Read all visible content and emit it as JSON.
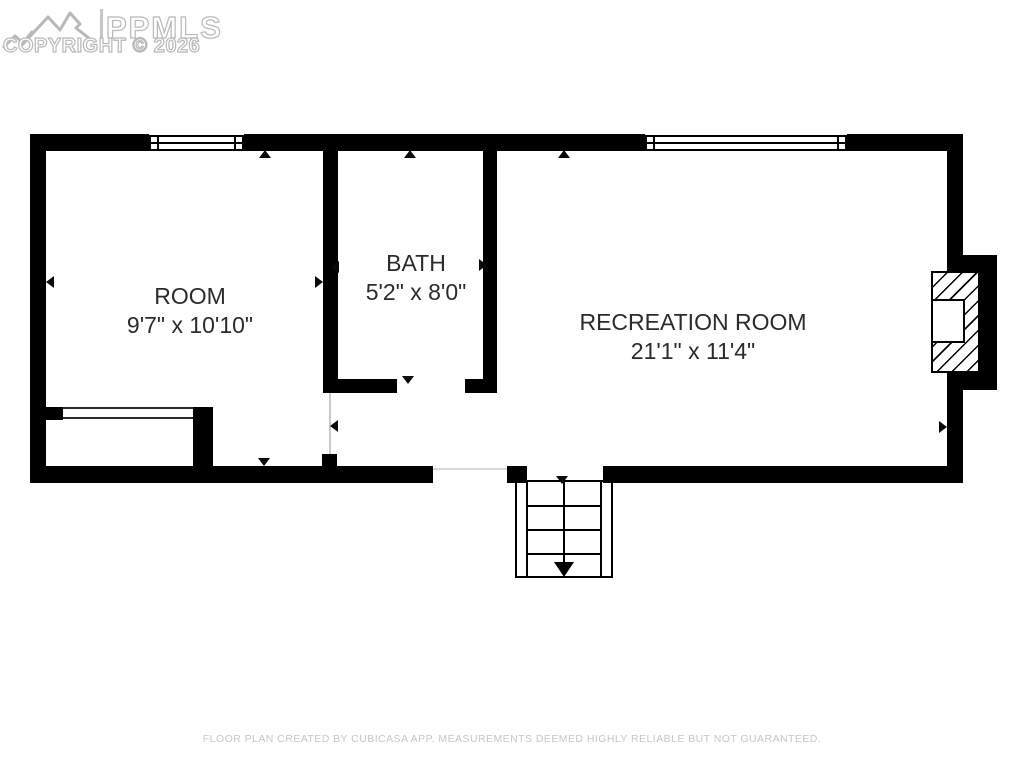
{
  "watermark": {
    "brand": "PPMLS",
    "copyright": "COPYRIGHT © 2026",
    "logo_icon": "mountain-range-icon",
    "color": "#b9b9b9"
  },
  "floorplan": {
    "rooms": [
      {
        "name": "ROOM",
        "dimensions": "9'7\" x 10'10\""
      },
      {
        "name": "BATH",
        "dimensions": "5'2\" x 8'0\""
      },
      {
        "name": "RECREATION ROOM",
        "dimensions": "21'1\" x 11'4\""
      }
    ],
    "features": {
      "windows": 2,
      "fireplace": true,
      "stairs_direction": "down",
      "closet_opening": true
    },
    "wall_color": "#000000",
    "label_color": "#2b2b2b"
  },
  "footer": {
    "disclaimer": "FLOOR PLAN CREATED BY CUBICASA APP. MEASUREMENTS DEEMED HIGHLY RELIABLE BUT NOT GUARANTEED."
  }
}
